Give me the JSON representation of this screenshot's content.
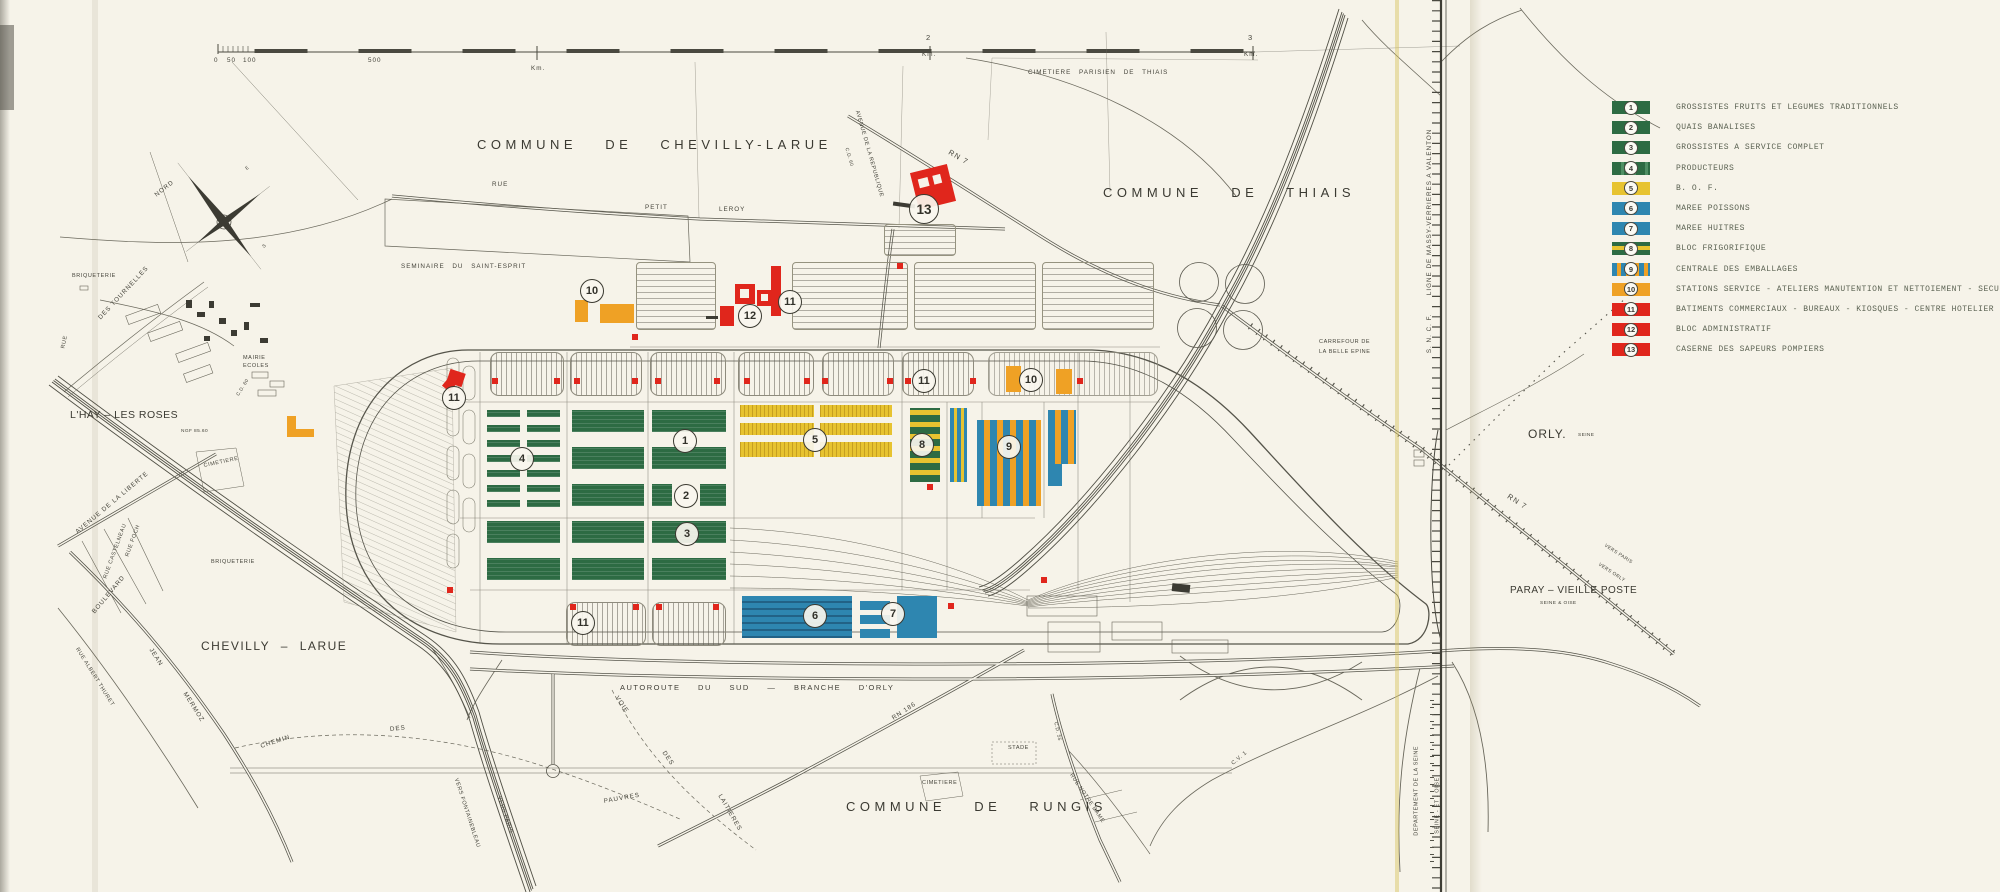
{
  "scalebar": {
    "t0": "0",
    "t50": "50",
    "t100": "100",
    "t500": "500",
    "km1": "Km.",
    "n2": "2",
    "km2": "Km.",
    "n3": "3",
    "km3": "Km."
  },
  "compass": {
    "nord": "NORD",
    "e": "E",
    "s": "S"
  },
  "labels": {
    "cim_thiais": "CIMETIERE PARISIEN DE THIAIS",
    "commune_chevilly": "COMMUNE DE CHEVILLY-LARUE",
    "commune_thiais": "COMMUNE DE THIAIS",
    "commune_rungis": "COMMUNE DE RUNGIS",
    "seminaire": "SEMINAIRE DU SAINT-ESPRIT",
    "rue": "RUE",
    "petit": "PETIT",
    "leroy": "LEROY",
    "briqueterie1": "BRIQUETERIE",
    "rue_w": "RUE",
    "tournelles": "DES TOURNELLES",
    "mairie": "MAIRIE",
    "ecoles": "ECOLES",
    "cd60": "C.D. 60",
    "lhay": "L'HAY – LES ROSES",
    "ngf": "NGF 85.60",
    "cim_lhay": "CIMETIERE",
    "liberte": "AVENUE DE LA LIBERTE",
    "foch": "RUE FOCH",
    "castelneau": "RUE CASTELNEAU",
    "boulevard": "BOULEVARD",
    "jean": "JEAN",
    "mermoz": "MERMOZ",
    "thuret": "RUE ALBERT THURET",
    "briqueterie2": "BRIQUETERIE",
    "chevilly": "CHEVILLY – LARUE",
    "chemin": "CHEMIN",
    "des1": "DES",
    "pauvres": "PAUVRES",
    "voie": "VOIE",
    "des2": "DES",
    "laitieres": "LAITIERES",
    "vers_fontainebleau": "VERS FONTAINEBLEAU",
    "vers_paris_sw": "VERS PARIS",
    "autoroute": "AUTOROUTE DU SUD — BRANCHE D'ORLY",
    "rn186": "RN 186",
    "stade": "STADE",
    "cim_rungis": "CIMETIERE",
    "cd55": "C.D. 55",
    "notredame": "RUE NOTRE DAME",
    "cv1": "C.V. 1",
    "orly": "ORLY.",
    "orly_seine": "SEINE",
    "rn7e": "RN 7",
    "vers_paris_e": "VERS PARIS",
    "vers_orly": "VERS ORLY",
    "paray": "PARAY – VIEILLE POSTE",
    "seine_oise": "SEINE & OISE",
    "sncf": "S. N. C. F.",
    "ligne_massy": "LIGNE DE MASSY-VERRIERES A VALENTON",
    "dept_seine": "DEPARTEMENT DE LA SEINE",
    "seine_et_oise": "SEINE - ET - OISE",
    "rn7n": "RN 7",
    "av_republique": "AVENUE DE LA REPUBLIQUE",
    "cd60b": "C.D. 60",
    "carrefour1": "CARREFOUR DE",
    "carrefour2": "LA BELLE EPINE"
  },
  "markers": {
    "m1": "1",
    "m2": "2",
    "m3": "3",
    "m4": "4",
    "m5": "5",
    "m6": "6",
    "m7": "7",
    "m8": "8",
    "m9": "9",
    "m10a": "10",
    "m10b": "10",
    "m11a": "11",
    "m11b": "11",
    "m11c": "11",
    "m11d": "11",
    "m12": "12",
    "m13": "13"
  },
  "legend": {
    "items": [
      {
        "num": "1",
        "label": "GROSSISTES FRUITS ET LEGUMES TRADITIONNELS"
      },
      {
        "num": "2",
        "label": "QUAIS BANALISES"
      },
      {
        "num": "3",
        "label": "GROSSISTES A SERVICE COMPLET"
      },
      {
        "num": "4",
        "label": "PRODUCTEURS"
      },
      {
        "num": "5",
        "label": "B. O. F."
      },
      {
        "num": "6",
        "label": "MAREE POISSONS"
      },
      {
        "num": "7",
        "label": "MAREE HUITRES"
      },
      {
        "num": "8",
        "label": "BLOC FRIGORIFIQUE"
      },
      {
        "num": "9",
        "label": "CENTRALE DES EMBALLAGES"
      },
      {
        "num": "10",
        "label": "STATIONS SERVICE - ATELIERS MANUTENTION ET NETTOIEMENT - SECURITE"
      },
      {
        "num": "11",
        "label": "BATIMENTS COMMERCIAUX - BUREAUX - KIOSQUES - CENTRE HOTELIER"
      },
      {
        "num": "12",
        "label": "BLOC ADMINISTRATIF"
      },
      {
        "num": "13",
        "label": "CASERNE DES SAPEURS POMPIERS"
      }
    ]
  },
  "colors": {
    "green": "#2d6b43",
    "yellow": "#e7c330",
    "blue": "#2e86b0",
    "orange": "#efa125",
    "red": "#e0261c",
    "line": "#5a584e",
    "paper": "#f6f3e9"
  }
}
